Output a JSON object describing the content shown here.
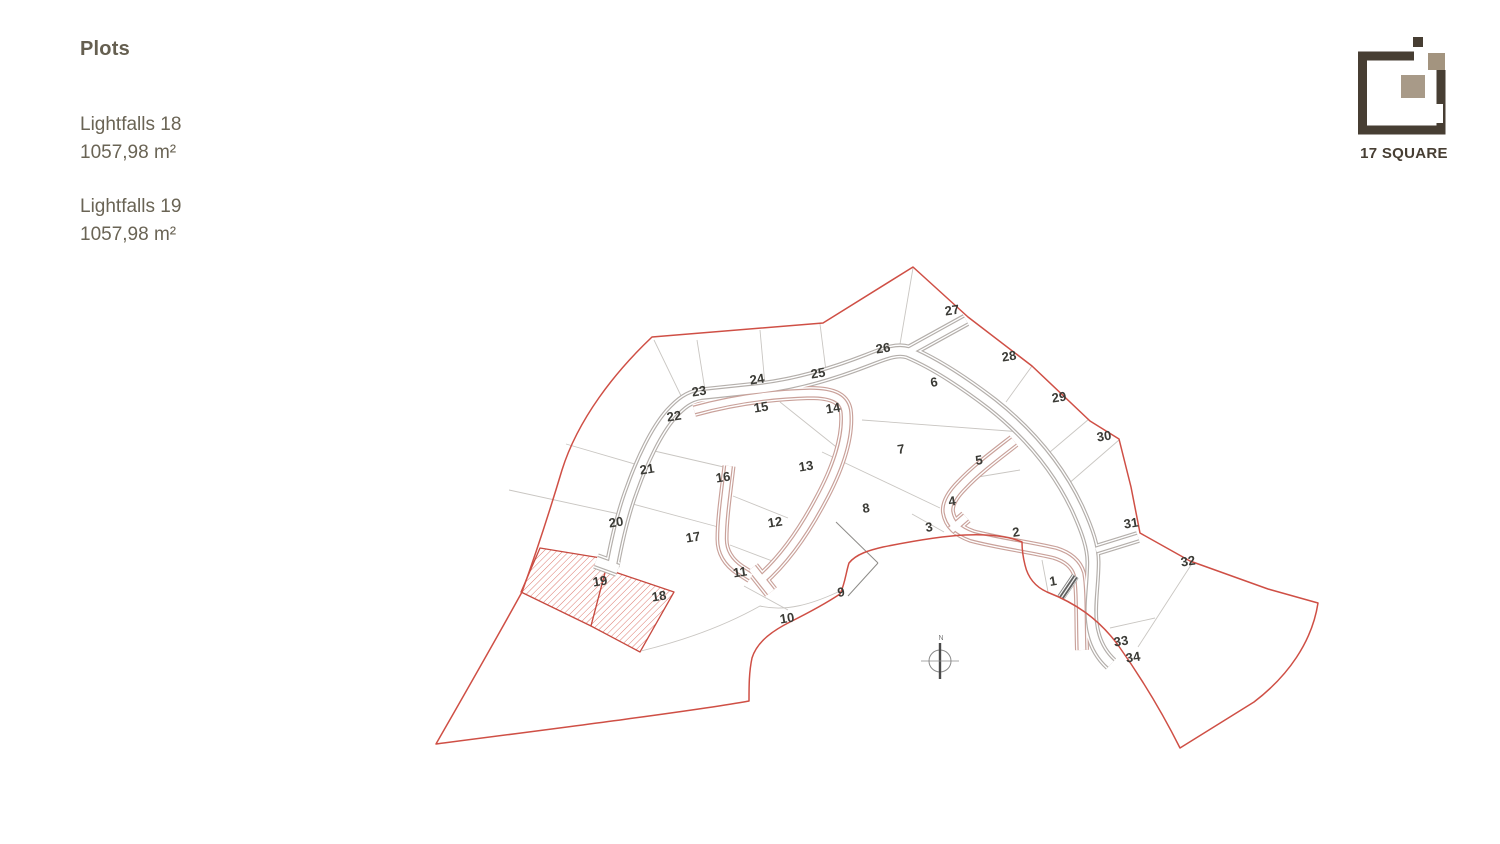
{
  "panel": {
    "title": "Plots",
    "plots": [
      {
        "name": "Lightfalls 18",
        "area": "1057,98 m²"
      },
      {
        "name": "Lightfalls 19",
        "area": "1057,98 m²"
      }
    ]
  },
  "logo": {
    "text": "17 SQUARE",
    "colors": {
      "dark": "#473e33",
      "taupe": "#a3947f",
      "taupe_light": "#a89a88"
    }
  },
  "map": {
    "colors": {
      "boundary": "#cf4f45",
      "highlight_stroke": "#c74a40",
      "hatch": "#d96a5f",
      "parcel": "#c9c6c2",
      "parcel_dark": "#8d8b88",
      "label": "#3a3a35",
      "road_gray": "#b4afab",
      "road_pink": "#c9a19a",
      "compass": "#8a8a8a"
    },
    "boundary": "M 652,337 L 823,323 L 913,267 L 968,317 L 1032,366 L 1090,421 L 1119,439 L 1131,487 L 1140,533 L 1190,561 L 1268,589 L 1318,603 C 1312,642 1288,676 1254,702 L 1180,748 C 1162,712 1140,676 1118,645 C 1098,618 1075,603 1047,592 C 1036,587 1028,578 1025,565 C 1023,557 1022,548 1022,542 C 1008,536 988,534 965,535 C 940,536 908,542 883,547 C 870,550 856,554 849,563 C 846,572 845,584 840,594 C 828,602 806,614 790,622 C 772,631 757,642 752,658 C 749,672 749,686 749,701 C 700,710 560,728 436,744 C 452,716 490,650 522,592 C 535,556 550,510 562,470 C 578,419 615,372 652,337 Z",
    "highlights": [
      {
        "id": "19",
        "points": "540,548 601,558 606,569 591,626 521,592"
      },
      {
        "id": "18",
        "points": "606,569 674,592 640,652 591,626"
      }
    ],
    "parcels": [
      [
        654,
        340,
        684,
        402
      ],
      [
        566,
        444,
        645,
        467
      ],
      [
        509,
        490,
        619,
        514
      ],
      [
        697,
        340,
        705,
        390
      ],
      [
        760,
        330,
        765,
        385
      ],
      [
        820,
        324,
        827,
        379
      ],
      [
        913,
        268,
        899,
        350
      ],
      [
        1032,
        366,
        1006,
        402
      ],
      [
        1089,
        419,
        1050,
        452
      ],
      [
        1119,
        440,
        1067,
        485
      ],
      [
        1193,
        562,
        1138,
        647
      ],
      [
        1110,
        628,
        1155,
        618
      ],
      [
        780,
        402,
        840,
        450
      ],
      [
        650,
        450,
        728,
        468
      ],
      [
        629,
        503,
        722,
        528
      ],
      [
        733,
        496,
        788,
        518
      ],
      [
        730,
        545,
        775,
        562
      ],
      [
        744,
        586,
        788,
        610
      ],
      [
        836,
        522,
        878,
        563,
        1
      ],
      [
        878,
        563,
        848,
        596,
        1
      ],
      [
        822,
        452,
        940,
        508
      ],
      [
        862,
        420,
        1022,
        432
      ],
      [
        966,
        479,
        1020,
        470
      ],
      [
        912,
        514,
        944,
        532
      ],
      [
        1042,
        560,
        1048,
        592
      ]
    ],
    "parcel_paths": [
      "M 641,651 C 690,639 728,624 760,606 C 786,612 812,604 838,592"
    ],
    "roads": [
      {
        "d": "M 612,566 C 618,534 624,510 632,489 C 642,461 656,431 671,414 C 681,403 689,397 701,395 L 758,389 C 795,385 832,374 868,360 C 888,352 898,349 908,352 C 932,362 962,381 992,404 C 1030,434 1058,468 1077,508 C 1088,532 1093,548 1093,562 C 1093,584 1089,604 1091,622 C 1093,641 1100,654 1111,664",
        "w": 10,
        "c": "#b4afab"
      },
      {
        "d": "M 618,569 L 596,561",
        "w": 11,
        "c": "#b4afab"
      },
      {
        "d": "M 694,410 C 730,400 770,394 810,393 C 834,393 845,399 846,413 C 848,437 838,468 820,501 C 804,531 785,559 761,580",
        "w": 9,
        "c": "#c9a19a"
      },
      {
        "d": "M 752,568 L 771,592",
        "w": 10,
        "c": "#c9a19a"
      },
      {
        "d": "M 729,466 C 726,492 722,518 722,539 C 722,552 728,562 740,570 L 751,577",
        "w": 8,
        "c": "#c9a19a"
      },
      {
        "d": "M 1014,441 C 996,455 976,470 962,485 C 952,495 947,504 948,512 C 950,524 958,531 972,536 C 998,543 1030,547 1055,553 C 1068,557 1076,564 1079,574 C 1082,590 1081,620 1082,650",
        "w": 9,
        "c": "#c9a19a"
      },
      {
        "d": "M 966,517 L 951,530",
        "w": 9,
        "c": "#c9a19a"
      },
      {
        "d": "M 908,352 L 966,320",
        "w": 8,
        "c": "#b4afab"
      },
      {
        "d": "M 1096,550 L 1138,537",
        "w": 7,
        "c": "#b4afab"
      }
    ],
    "labels": [
      {
        "n": "1",
        "x": 1053,
        "y": 581
      },
      {
        "n": "2",
        "x": 1016,
        "y": 532
      },
      {
        "n": "3",
        "x": 929,
        "y": 527
      },
      {
        "n": "4",
        "x": 952,
        "y": 501
      },
      {
        "n": "5",
        "x": 979,
        "y": 460
      },
      {
        "n": "6",
        "x": 934,
        "y": 382
      },
      {
        "n": "7",
        "x": 901,
        "y": 449
      },
      {
        "n": "8",
        "x": 866,
        "y": 508
      },
      {
        "n": "9",
        "x": 841,
        "y": 592
      },
      {
        "n": "10",
        "x": 787,
        "y": 618
      },
      {
        "n": "11",
        "x": 740,
        "y": 572
      },
      {
        "n": "12",
        "x": 775,
        "y": 522
      },
      {
        "n": "13",
        "x": 806,
        "y": 466
      },
      {
        "n": "14",
        "x": 833,
        "y": 408
      },
      {
        "n": "15",
        "x": 761,
        "y": 407
      },
      {
        "n": "16",
        "x": 723,
        "y": 477
      },
      {
        "n": "17",
        "x": 693,
        "y": 537
      },
      {
        "n": "18",
        "x": 659,
        "y": 596
      },
      {
        "n": "19",
        "x": 600,
        "y": 581
      },
      {
        "n": "20",
        "x": 616,
        "y": 522
      },
      {
        "n": "21",
        "x": 647,
        "y": 469
      },
      {
        "n": "22",
        "x": 674,
        "y": 416
      },
      {
        "n": "23",
        "x": 699,
        "y": 391
      },
      {
        "n": "24",
        "x": 757,
        "y": 379
      },
      {
        "n": "25",
        "x": 818,
        "y": 373
      },
      {
        "n": "26",
        "x": 883,
        "y": 348
      },
      {
        "n": "27",
        "x": 952,
        "y": 310
      },
      {
        "n": "28",
        "x": 1009,
        "y": 356
      },
      {
        "n": "29",
        "x": 1059,
        "y": 397
      },
      {
        "n": "30",
        "x": 1104,
        "y": 436
      },
      {
        "n": "31",
        "x": 1131,
        "y": 523
      },
      {
        "n": "32",
        "x": 1188,
        "y": 561
      },
      {
        "n": "33",
        "x": 1121,
        "y": 641
      },
      {
        "n": "34",
        "x": 1133,
        "y": 657
      }
    ],
    "compass": {
      "x": 940,
      "y": 661,
      "label": "N"
    },
    "gate": {
      "x": 1068,
      "y": 587,
      "angle": -56,
      "len": 26,
      "w": 7.5
    }
  }
}
